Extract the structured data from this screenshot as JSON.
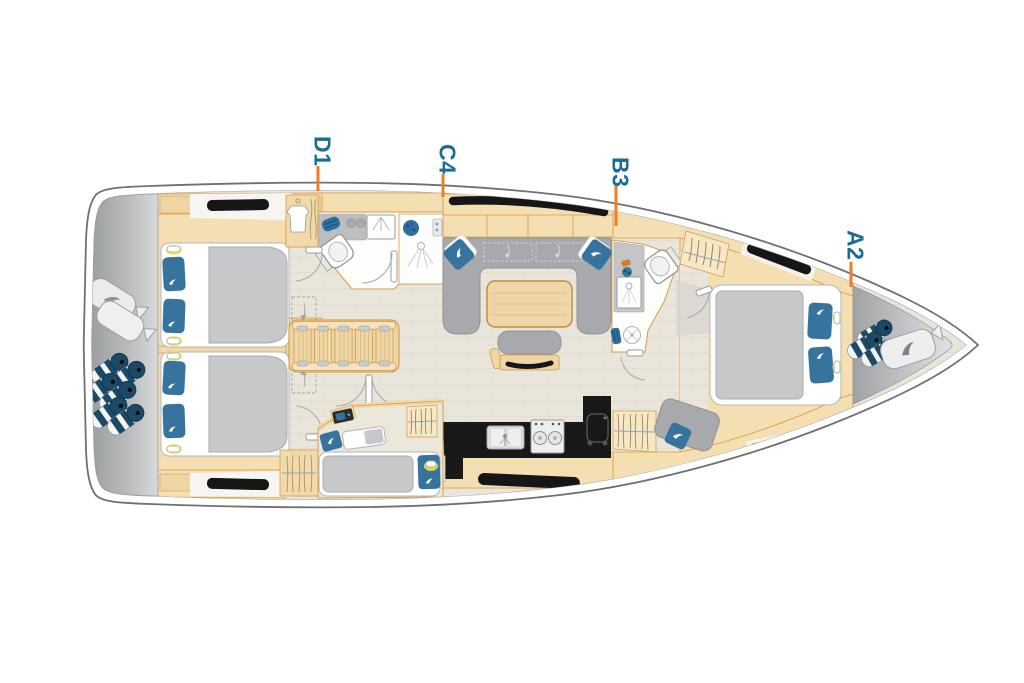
{
  "plan": {
    "type": "sailing-yacht-interior-layout-top-view",
    "cabin_labels": [
      {
        "id": "label-d1",
        "text": "D1"
      },
      {
        "id": "label-c4",
        "text": "C4"
      },
      {
        "id": "label-b3",
        "text": "B3"
      },
      {
        "id": "label-a2",
        "text": "A2"
      }
    ],
    "label_color": "#1a6b96",
    "leader_color": "#ee7e22",
    "palette": {
      "hull_outline": "#6e7072",
      "deck_gray": "#a4a6a8",
      "wood": "#f4dfb3",
      "wood_edge": "#d79d45",
      "floor": "#eae5da",
      "upholstery_gray": "#a7a9ac",
      "bedding_gray": "#c7c8ca",
      "cushion_blue": "#36749e",
      "fender_navy": "#1c4a66",
      "window_black": "#161616",
      "reading_light_yellow": "#f2e23e"
    },
    "features": [
      "stern-sail-bags",
      "stern-fenders",
      "aft-cabin-upper-double-bed",
      "aft-cabin-lower-double-bed",
      "companionway-stairs",
      "aft-head-toilet-sink-shower",
      "wardrobe-lockers",
      "saloon-u-settee",
      "saloon-table",
      "saloon-bench-tv",
      "galley-sink-stove-fridge",
      "single-berth-cabin",
      "forward-head-toilet-sink-shower",
      "hanging-lockers",
      "forward-seat-cushion",
      "owner-cabin-island-bed",
      "bow-fenders",
      "bow-sail-bag",
      "hull-windows-hatches"
    ]
  }
}
